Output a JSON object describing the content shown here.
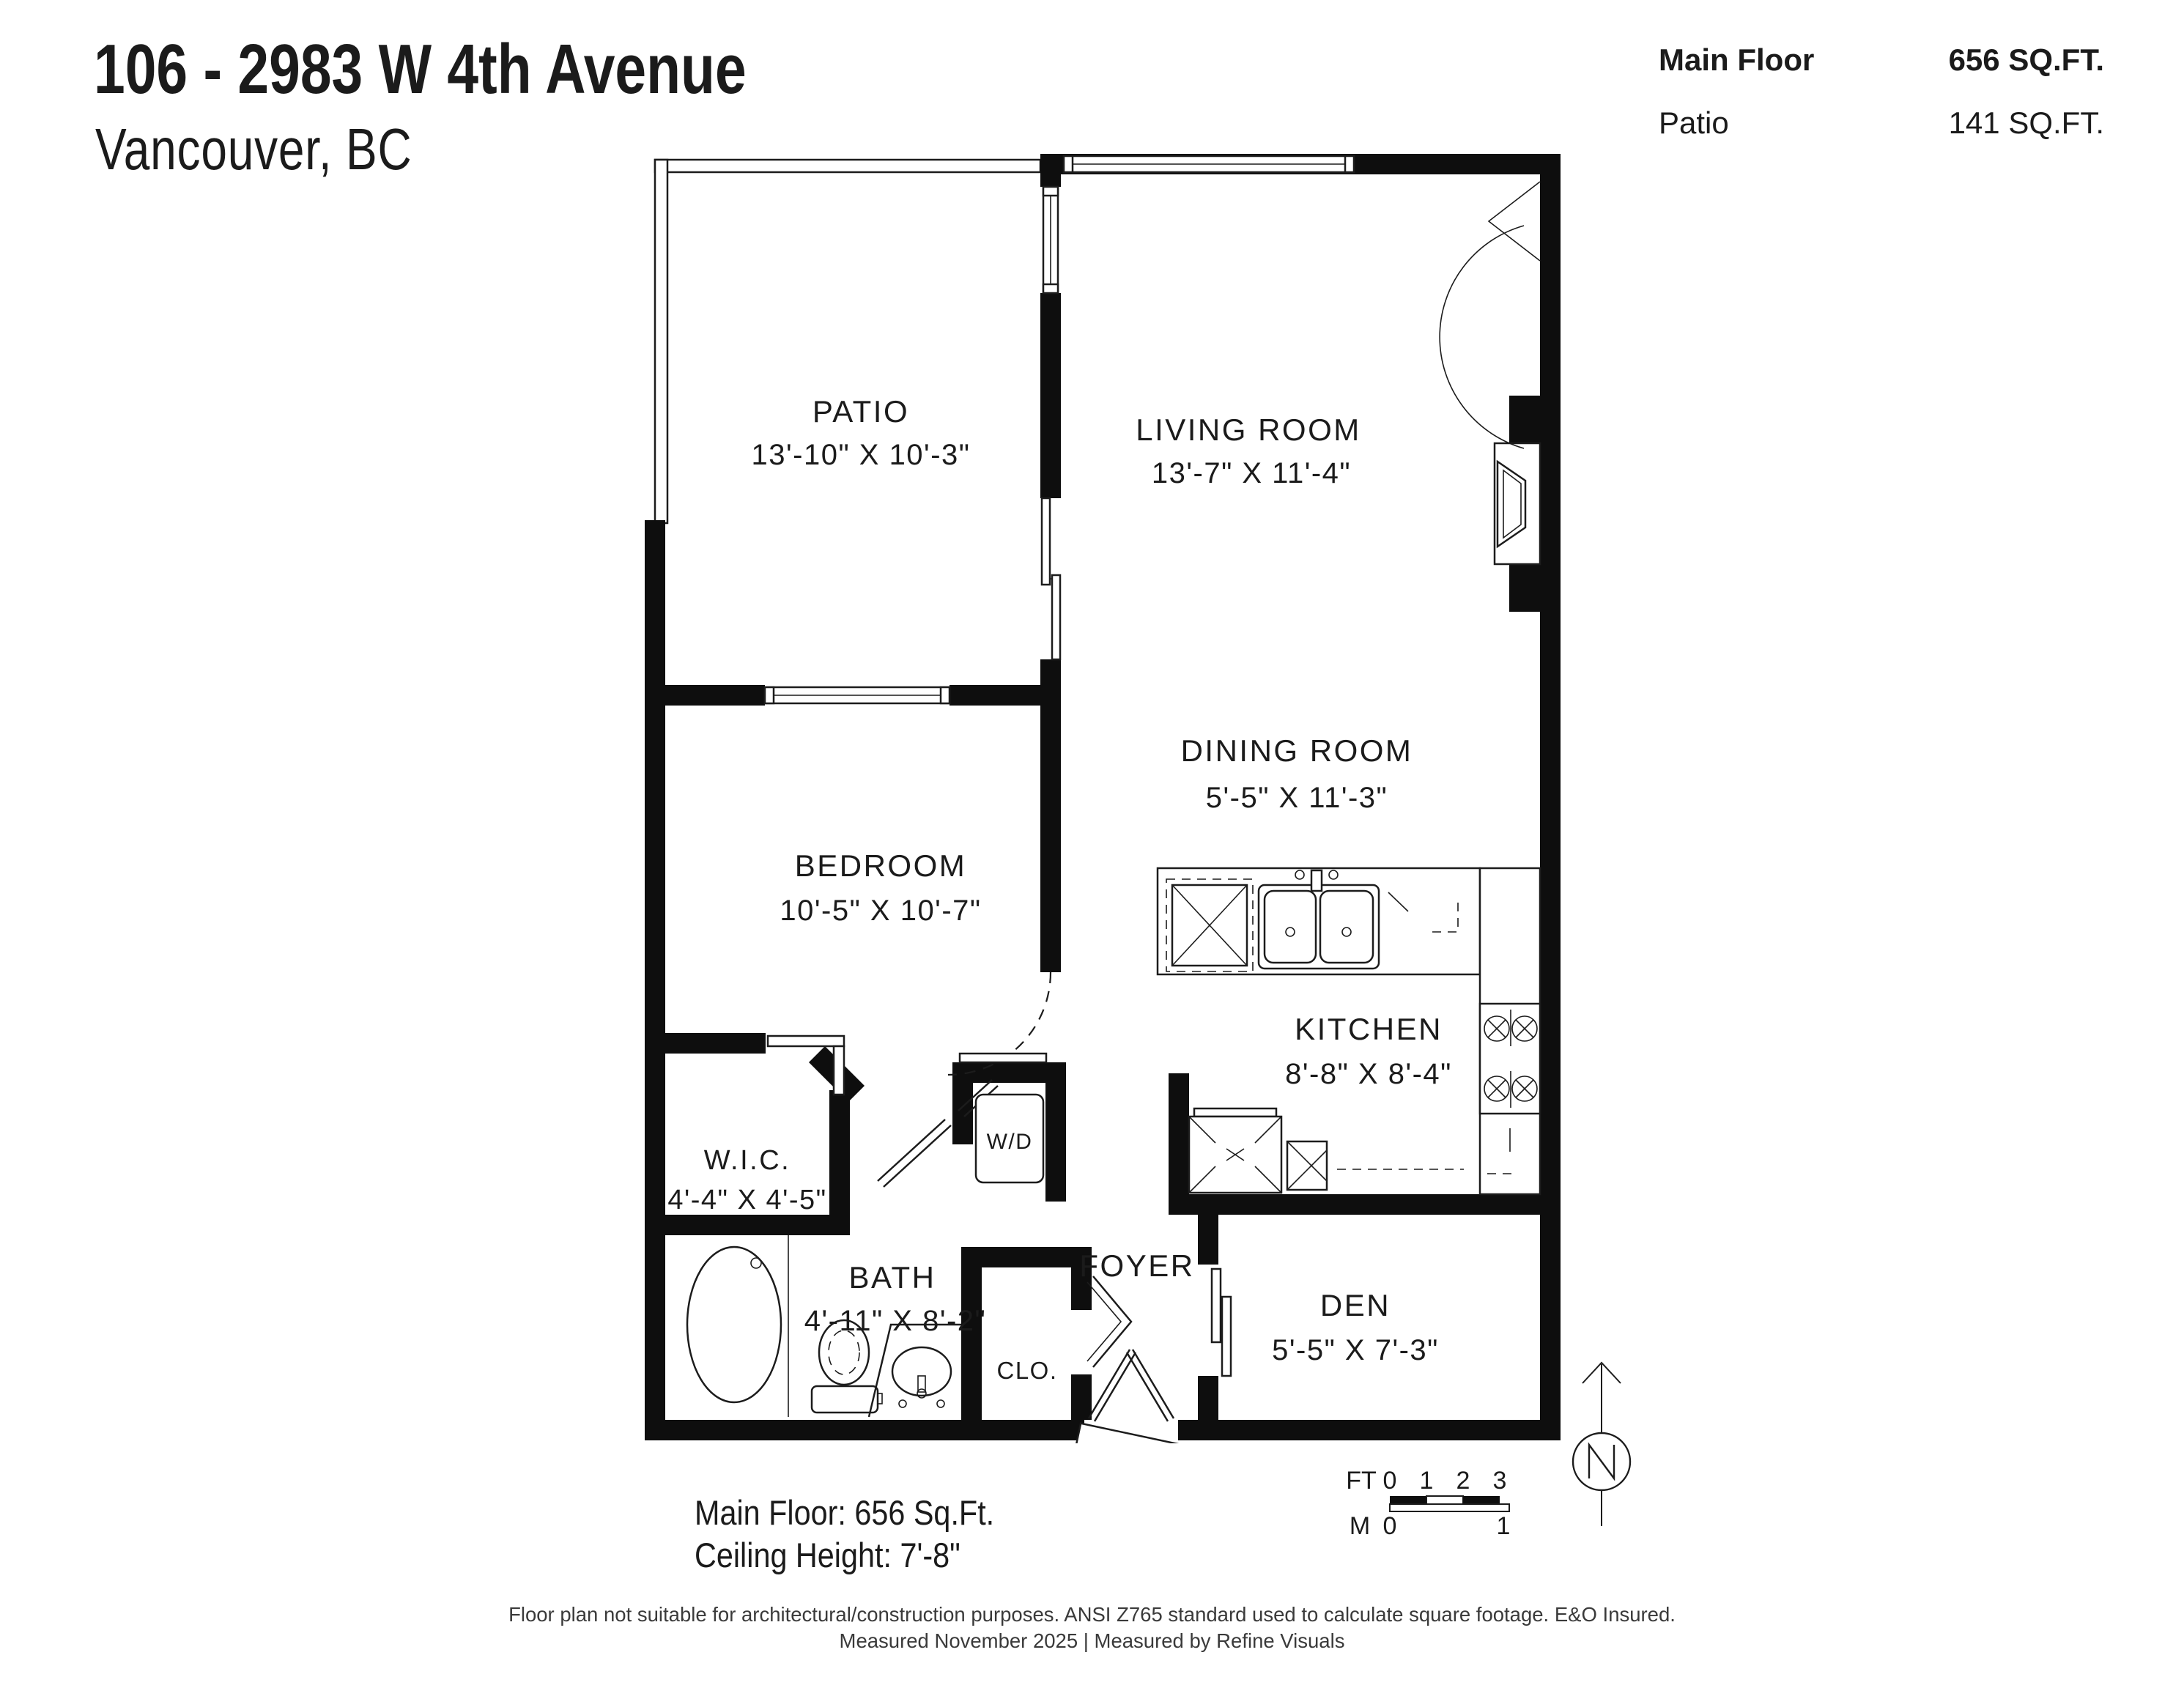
{
  "header": {
    "title": "106 - 2983 W 4th Avenue",
    "subtitle": "Vancouver, BC"
  },
  "area_summary": {
    "rows": [
      {
        "label": "Main Floor",
        "value": "656 SQ.FT."
      },
      {
        "label": "Patio",
        "value": "141 SQ.FT."
      }
    ]
  },
  "rooms": {
    "patio": {
      "name": "PATIO",
      "dims": "13'-10\" X 10'-3\""
    },
    "living": {
      "name": "LIVING ROOM",
      "dims": "13'-7\" X 11'-4\""
    },
    "dining": {
      "name": "DINING ROOM",
      "dims": "5'-5\" X 11'-3\""
    },
    "bedroom": {
      "name": "BEDROOM",
      "dims": "10'-5\" X 10'-7\""
    },
    "kitchen": {
      "name": "KITCHEN",
      "dims": "8'-8\" X 8'-4\""
    },
    "wic": {
      "name": "W.I.C.",
      "dims": "4'-4\" X 4'-5\""
    },
    "bath": {
      "name": "BATH",
      "dims": "4'-11\" X 8'-2\""
    },
    "foyer": {
      "name": "FOYER"
    },
    "closet": {
      "name": "CLO."
    },
    "den": {
      "name": "DEN",
      "dims": "5'-5\" X 7'-3\""
    },
    "laundry": {
      "name": "W/D"
    }
  },
  "floor_stats": {
    "line1": "Main Floor: 656 Sq.Ft.",
    "line2": "Ceiling Height: 7'-8\""
  },
  "scale_bar": {
    "ft_label": "FT",
    "ft_ticks": [
      "0",
      "1",
      "2",
      "3"
    ],
    "m_label": "M",
    "m_ticks": [
      "0",
      "1"
    ]
  },
  "compass": {
    "label": "N"
  },
  "disclaimer": {
    "line1": "Floor plan not suitable for architectural/construction purposes. ANSI Z765 standard used to calculate square footage. E&O Insured.",
    "line2": "Measured November 2025 | Measured by Refine Visuals"
  }
}
